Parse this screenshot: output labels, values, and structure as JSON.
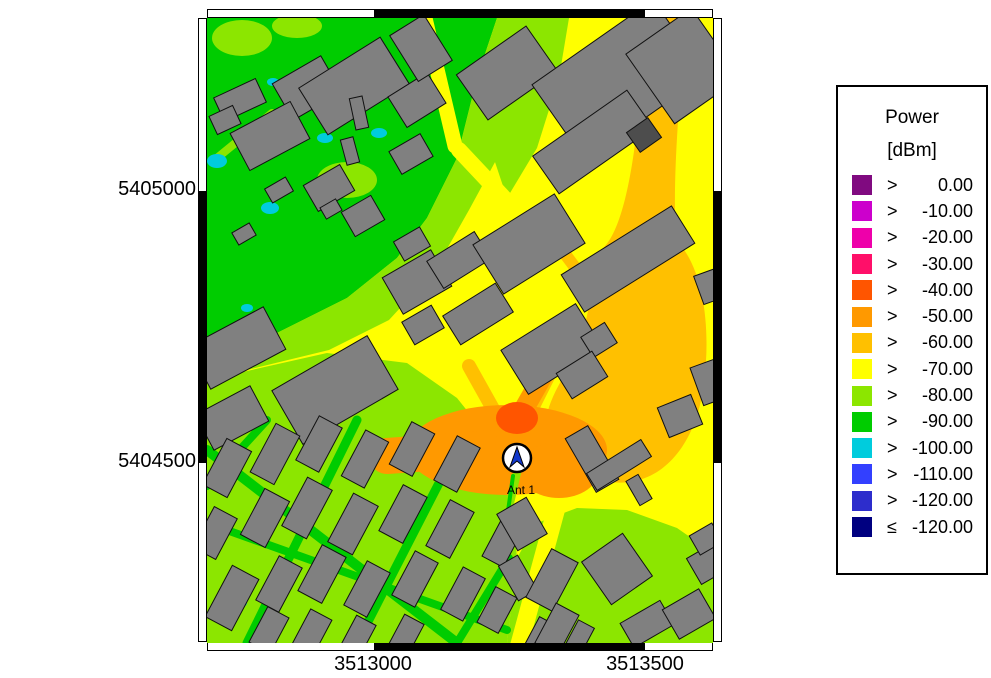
{
  "legend": {
    "title_line1": "Power",
    "title_line2": "[dBm]",
    "box": {
      "x": 836,
      "y": 85,
      "w": 152,
      "h": 490
    },
    "entries": [
      {
        "op": ">",
        "value": "0.00",
        "color": "#800A80"
      },
      {
        "op": ">",
        "value": "-10.00",
        "color": "#CC00CC"
      },
      {
        "op": ">",
        "value": "-20.00",
        "color": "#EE00AA"
      },
      {
        "op": ">",
        "value": "-30.00",
        "color": "#FF0F69"
      },
      {
        "op": ">",
        "value": "-40.00",
        "color": "#FF5500"
      },
      {
        "op": ">",
        "value": "-50.00",
        "color": "#FF9900"
      },
      {
        "op": ">",
        "value": "-60.00",
        "color": "#FFC000"
      },
      {
        "op": ">",
        "value": "-70.00",
        "color": "#FFFF00"
      },
      {
        "op": ">",
        "value": "-80.00",
        "color": "#8CE600"
      },
      {
        "op": ">",
        "value": "-90.00",
        "color": "#00CC00"
      },
      {
        "op": ">",
        "value": "-100.00",
        "color": "#00CCDD"
      },
      {
        "op": ">",
        "value": "-110.00",
        "color": "#3340FF"
      },
      {
        "op": ">",
        "value": "-120.00",
        "color": "#2D2DCC"
      },
      {
        "op": "≤",
        "value": "-120.00",
        "color": "#000080"
      }
    ]
  },
  "frame": {
    "map": {
      "x": 207,
      "y": 18,
      "w": 506,
      "h": 624
    },
    "band": 9,
    "x_ticks": [
      {
        "label": "3513000",
        "px": 373
      },
      {
        "label": "3513500",
        "px": 645
      }
    ],
    "y_ticks": [
      {
        "label": "5405000",
        "py": 190
      },
      {
        "label": "5404500",
        "py": 462
      }
    ],
    "x_black_segment": [
      373,
      644
    ],
    "y_black_segment": [
      190,
      462
    ]
  },
  "antenna": {
    "label": "Ant 1",
    "x": 310,
    "y": 440,
    "r": 14
  },
  "map_render": {
    "colors": {
      "Y": "#FFFF00",
      "G": "#00CC00",
      "L": "#8CE600",
      "C": "#00CCDD",
      "A": "#FFC000",
      "O": "#FF9900",
      "R": "#FF5500",
      "B": "#808080",
      "D": "#4D4D4D",
      "W": "#FFFFFF",
      "ANT": "#1238CC"
    },
    "zones": [
      {
        "t": "rect",
        "f": "Y",
        "x": 0,
        "y": 0,
        "w": 506,
        "h": 625
      },
      {
        "t": "poly",
        "f": "G",
        "p": [
          [
            0,
            0
          ],
          [
            290,
            0
          ],
          [
            270,
            60
          ],
          [
            250,
            140
          ],
          [
            220,
            200
          ],
          [
            190,
            240
          ],
          [
            140,
            280
          ],
          [
            60,
            320
          ],
          [
            0,
            340
          ]
        ]
      },
      {
        "t": "poly",
        "f": "L",
        "p": [
          [
            290,
            0
          ],
          [
            362,
            0
          ],
          [
            340,
            62
          ],
          [
            300,
            122
          ],
          [
            262,
            192
          ],
          [
            228,
            252
          ],
          [
            182,
            302
          ],
          [
            122,
            332
          ],
          [
            40,
            352
          ],
          [
            0,
            362
          ],
          [
            0,
            340
          ],
          [
            60,
            320
          ],
          [
            140,
            280
          ],
          [
            190,
            240
          ],
          [
            220,
            200
          ],
          [
            250,
            140
          ],
          [
            270,
            60
          ]
        ]
      },
      {
        "t": "poly",
        "f": "L",
        "p": [
          [
            0,
            362
          ],
          [
            120,
            335
          ],
          [
            200,
            345
          ],
          [
            250,
            380
          ],
          [
            290,
            430
          ],
          [
            305,
            480
          ],
          [
            310,
            540
          ],
          [
            300,
            625
          ],
          [
            0,
            625
          ]
        ]
      },
      {
        "t": "poly",
        "f": "L",
        "p": [
          [
            300,
            625
          ],
          [
            310,
            540
          ],
          [
            330,
            505
          ],
          [
            370,
            490
          ],
          [
            420,
            492
          ],
          [
            470,
            510
          ],
          [
            506,
            535
          ],
          [
            506,
            625
          ]
        ]
      },
      {
        "t": "poly",
        "f": "L",
        "p": [
          [
            322,
            0
          ],
          [
            362,
            0
          ],
          [
            352,
            60
          ],
          [
            330,
            130
          ],
          [
            300,
            180
          ],
          [
            280,
            120
          ],
          [
            300,
            60
          ]
        ]
      },
      {
        "t": "ell",
        "f": "L",
        "cx": 35,
        "cy": 20,
        "rx": 30,
        "ry": 18
      },
      {
        "t": "ell",
        "f": "L",
        "cx": 90,
        "cy": 8,
        "rx": 25,
        "ry": 12
      },
      {
        "t": "ell",
        "f": "L",
        "cx": 140,
        "cy": 162,
        "rx": 30,
        "ry": 18
      },
      {
        "t": "line",
        "f": "L",
        "w": 8,
        "p": [
          [
            65,
            95
          ],
          [
            10,
            140
          ]
        ]
      },
      {
        "t": "line",
        "f": "Y",
        "w": 15,
        "p": [
          [
            218,
            0
          ],
          [
            248,
            128
          ]
        ]
      },
      {
        "t": "line",
        "f": "Y",
        "w": 16,
        "p": [
          [
            252,
            132
          ],
          [
            330,
            215
          ]
        ]
      },
      {
        "t": "line",
        "f": "G",
        "w": 10,
        "p": [
          [
            0,
            432
          ],
          [
            250,
            625
          ]
        ]
      },
      {
        "t": "line",
        "f": "G",
        "w": 9,
        "p": [
          [
            150,
            402
          ],
          [
            40,
            625
          ]
        ]
      },
      {
        "t": "line",
        "f": "G",
        "w": 9,
        "p": [
          [
            250,
            430
          ],
          [
            150,
            625
          ]
        ]
      },
      {
        "t": "line",
        "f": "G",
        "w": 8,
        "p": [
          [
            0,
            505
          ],
          [
            300,
            612
          ]
        ]
      },
      {
        "t": "line",
        "f": "G",
        "w": 8,
        "p": [
          [
            60,
            402
          ],
          [
            0,
            468
          ]
        ]
      },
      {
        "t": "line",
        "f": "G",
        "w": 8,
        "p": [
          [
            302,
            540
          ],
          [
            250,
            625
          ]
        ]
      },
      {
        "t": "line",
        "f": "Y",
        "w": 18,
        "p": [
          [
            356,
            466
          ],
          [
            312,
            628
          ]
        ]
      },
      {
        "t": "path",
        "f": "A",
        "d": "M438,0 L478,0 C473,85 465,155 469,222 C497,250 505,312 496,372 C487,430 452,470 404,464 C366,459 337,432 339,404 C341,377 363,353 373,324 C383,294 385,263 393,233 C421,212 433,115 438,0 Z"
      },
      {
        "t": "line",
        "f": "A",
        "w": 12,
        "p": [
          [
            340,
            212
          ],
          [
            400,
            292
          ]
        ]
      },
      {
        "t": "line",
        "f": "A",
        "w": 18,
        "p": [
          [
            310,
            416
          ],
          [
            352,
            332
          ]
        ]
      },
      {
        "t": "line",
        "f": "A",
        "w": 14,
        "p": [
          [
            262,
            348
          ],
          [
            300,
            416
          ]
        ]
      },
      {
        "t": "ell",
        "f": "O",
        "cx": 300,
        "cy": 432,
        "rx": 100,
        "ry": 45
      },
      {
        "t": "ell",
        "f": "O",
        "cx": 352,
        "cy": 452,
        "rx": 40,
        "ry": 28
      },
      {
        "t": "line",
        "f": "O",
        "w": 36,
        "p": [
          [
            180,
            438
          ],
          [
            290,
            430
          ]
        ]
      },
      {
        "t": "line",
        "f": "O",
        "w": 20,
        "p": [
          [
            298,
            424
          ],
          [
            346,
            340
          ]
        ]
      },
      {
        "t": "ell",
        "f": "R",
        "cx": 310,
        "cy": 400,
        "rx": 21,
        "ry": 16
      },
      {
        "t": "line",
        "f": "L",
        "w": 8,
        "p": [
          [
            310,
            455
          ],
          [
            295,
            520
          ]
        ]
      },
      {
        "t": "line",
        "f": "G",
        "w": 4,
        "p": [
          [
            306,
            458
          ],
          [
            300,
            500
          ]
        ]
      },
      {
        "t": "ell",
        "f": "C",
        "cx": 10,
        "cy": 143,
        "rx": 10,
        "ry": 7
      },
      {
        "t": "ell",
        "f": "C",
        "cx": 63,
        "cy": 190,
        "rx": 9,
        "ry": 6
      },
      {
        "t": "ell",
        "f": "C",
        "cx": 118,
        "cy": 120,
        "rx": 8,
        "ry": 5
      },
      {
        "t": "ell",
        "f": "C",
        "cx": 172,
        "cy": 115,
        "rx": 8,
        "ry": 5
      },
      {
        "t": "ell",
        "f": "C",
        "cx": 66,
        "cy": 64,
        "rx": 6,
        "ry": 4
      },
      {
        "t": "ell",
        "f": "C",
        "cx": 94,
        "cy": 76,
        "rx": 7,
        "ry": 4
      },
      {
        "t": "ell",
        "f": "C",
        "cx": 458,
        "cy": 46,
        "rx": 10,
        "ry": 6
      },
      {
        "t": "ell",
        "f": "C",
        "cx": 40,
        "cy": 290,
        "rx": 6,
        "ry": 4
      },
      {
        "t": "ell",
        "f": "C",
        "cx": 210,
        "cy": 575,
        "rx": 5,
        "ry": 4
      },
      {
        "t": "ell",
        "f": "C",
        "cx": 35,
        "cy": 585,
        "rx": 5,
        "ry": 4
      },
      {
        "t": "ell",
        "f": "C",
        "cx": 505,
        "cy": 372,
        "rx": 6,
        "ry": 5
      }
    ],
    "buildings": [
      [
        33,
        82,
        46,
        26,
        -25
      ],
      [
        18,
        102,
        26,
        20,
        -25
      ],
      [
        100,
        70,
        56,
        42,
        -30
      ],
      [
        63,
        118,
        68,
        42,
        -28
      ],
      [
        147,
        68,
        96,
        55,
        -32
      ],
      [
        152,
        95,
        13,
        32,
        -12
      ],
      [
        204,
        136,
        36,
        26,
        -30
      ],
      [
        210,
        82,
        46,
        36,
        -32
      ],
      [
        214,
        30,
        40,
        54,
        -32
      ],
      [
        72,
        172,
        24,
        16,
        -30
      ],
      [
        122,
        170,
        42,
        30,
        -30
      ],
      [
        156,
        198,
        34,
        28,
        -30
      ],
      [
        124,
        191,
        18,
        13,
        -30
      ],
      [
        143,
        133,
        13,
        26,
        -15
      ],
      [
        37,
        216,
        20,
        14,
        -30
      ],
      [
        300,
        55,
        85,
        55,
        -35
      ],
      [
        412,
        62,
        148,
        92,
        -35
      ],
      [
        386,
        124,
        115,
        46,
        -35
      ],
      [
        476,
        48,
        80,
        85,
        -35
      ],
      [
        437,
        117,
        26,
        24,
        -35,
        "d"
      ],
      [
        30,
        330,
        85,
        48,
        -28
      ],
      [
        128,
        372,
        110,
        62,
        -30
      ],
      [
        25,
        400,
        62,
        40,
        -28
      ],
      [
        210,
        264,
        56,
        42,
        -30
      ],
      [
        216,
        307,
        34,
        26,
        -30
      ],
      [
        252,
        242,
        56,
        32,
        -32
      ],
      [
        271,
        296,
        62,
        34,
        -32
      ],
      [
        205,
        226,
        30,
        22,
        -30
      ],
      [
        322,
        226,
        96,
        58,
        -32
      ],
      [
        421,
        241,
        130,
        44,
        -32
      ],
      [
        345,
        331,
        88,
        52,
        -32
      ],
      [
        392,
        322,
        28,
        24,
        -32
      ],
      [
        375,
        357,
        42,
        30,
        -32
      ],
      [
        385,
        441,
        26,
        62,
        -30
      ],
      [
        412,
        447,
        64,
        20,
        -32
      ],
      [
        432,
        472,
        14,
        28,
        -30
      ],
      [
        473,
        398,
        36,
        32,
        -22
      ],
      [
        504,
        268,
        26,
        30,
        -20
      ],
      [
        503,
        364,
        28,
        40,
        -20
      ],
      [
        20,
        450,
        52,
        28,
        -62
      ],
      [
        8,
        515,
        46,
        26,
        -62
      ],
      [
        25,
        580,
        58,
        30,
        -62
      ],
      [
        62,
        612,
        40,
        24,
        -62
      ],
      [
        68,
        436,
        55,
        27,
        -62
      ],
      [
        58,
        500,
        52,
        28,
        -62
      ],
      [
        72,
        566,
        50,
        26,
        -62
      ],
      [
        112,
        426,
        50,
        26,
        -62
      ],
      [
        100,
        490,
        55,
        28,
        -62
      ],
      [
        115,
        556,
        52,
        27,
        -62
      ],
      [
        104,
        616,
        44,
        24,
        -62
      ],
      [
        158,
        441,
        52,
        26,
        -62
      ],
      [
        146,
        506,
        55,
        28,
        -62
      ],
      [
        160,
        571,
        50,
        26,
        -62
      ],
      [
        150,
        620,
        40,
        22,
        -62
      ],
      [
        205,
        431,
        48,
        26,
        -62
      ],
      [
        196,
        496,
        52,
        27,
        -62
      ],
      [
        208,
        561,
        50,
        26,
        -62
      ],
      [
        198,
        619,
        40,
        22,
        -62
      ],
      [
        250,
        446,
        50,
        26,
        -62
      ],
      [
        243,
        511,
        52,
        27,
        -62
      ],
      [
        256,
        576,
        48,
        25,
        -62
      ],
      [
        295,
        526,
        40,
        24,
        -62
      ],
      [
        290,
        592,
        40,
        24,
        -62
      ],
      [
        315,
        506,
        34,
        42,
        -30
      ],
      [
        311,
        560,
        22,
        40,
        -30
      ],
      [
        332,
        621,
        40,
        20,
        -62
      ],
      [
        371,
        622,
        36,
        18,
        -62
      ],
      [
        410,
        551,
        50,
        52,
        -35
      ],
      [
        440,
        606,
        46,
        28,
        -30
      ],
      [
        482,
        596,
        42,
        34,
        -30
      ],
      [
        500,
        546,
        30,
        30,
        -30
      ],
      [
        499,
        521,
        26,
        22,
        -30
      ],
      [
        345,
        562,
        55,
        30,
        -62
      ],
      [
        350,
        611,
        45,
        26,
        -62
      ]
    ]
  }
}
